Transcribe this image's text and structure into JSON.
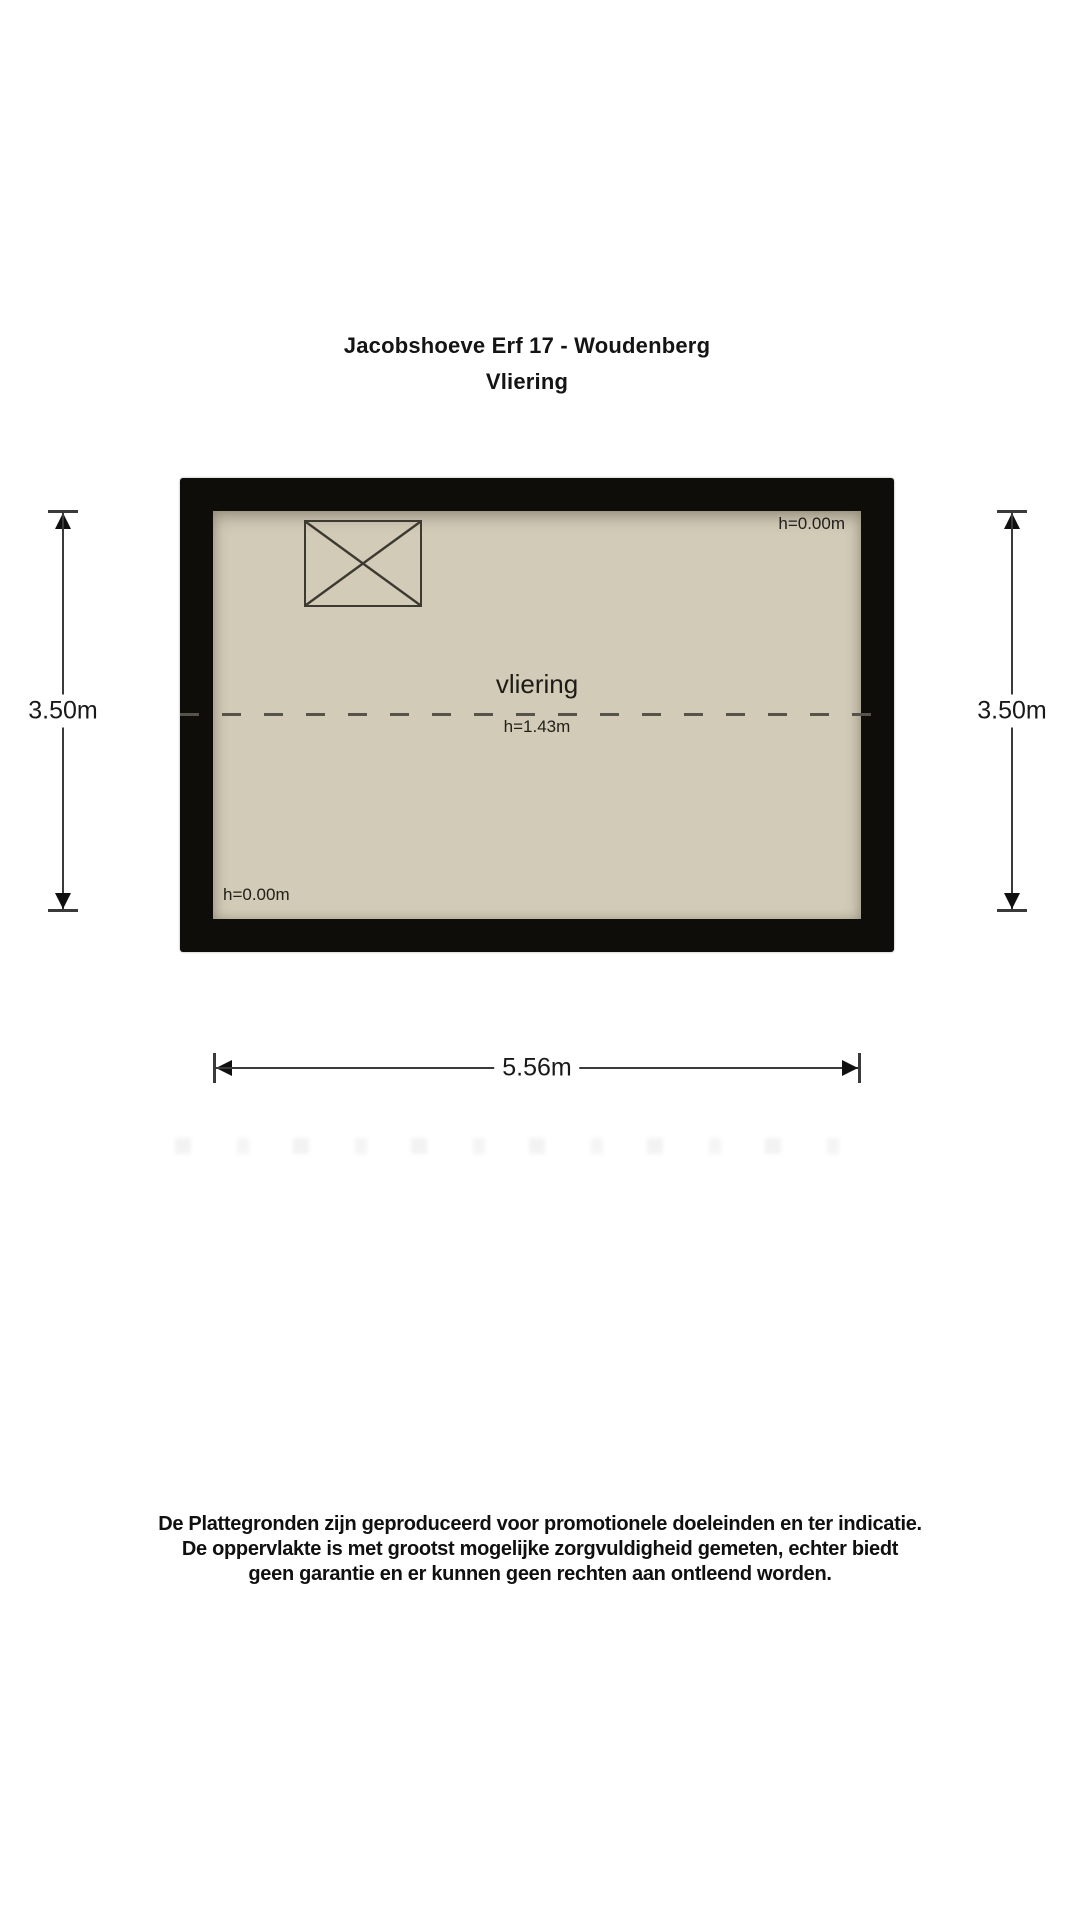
{
  "title": {
    "line1": "Jacobshoeve Erf 17 - Woudenberg",
    "line2": "Vliering"
  },
  "plan": {
    "room_label": "vliering",
    "height_label_center": "h=1.43m",
    "height_label_top_right": "h=0.00m",
    "height_label_bottom_left": "h=0.00m"
  },
  "dimensions": {
    "left": "3.50m",
    "right": "3.50m",
    "bottom": "5.56m"
  },
  "disclaimer": {
    "lines": [
      "De Plattegronden zijn geproduceerd voor promotionele doeleinden en ter indicatie.",
      "De oppervlakte is met grootst mogelijke zorgvuldigheid gemeten, echter biedt",
      "geen garantie en er kunnen geen rechten aan ontleend worden."
    ]
  },
  "colors": {
    "wall": "#0e0d0a",
    "floor": "#d2cbb8",
    "outline": "#3c3a30",
    "dash": "#55534a",
    "dim": "#3a3a3a",
    "text": "#1a1a1a"
  }
}
